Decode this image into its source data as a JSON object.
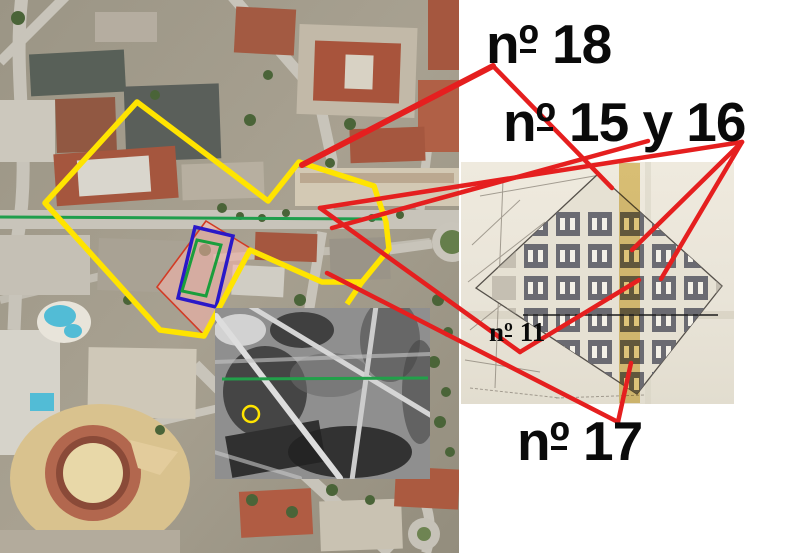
{
  "figure": {
    "type": "annotated-composite-map-figure",
    "description": "Modern aerial photo with outlined shelter zones, historical plan scan and WWII-era aerial inset, linked by red call-out lines"
  },
  "labels": [
    {
      "id": "no18",
      "font": "sans",
      "x": 486,
      "y": 17,
      "size": 55,
      "parts": {
        "prefix": "n",
        "ordinal": "º",
        "rest": " 18"
      }
    },
    {
      "id": "no15y16",
      "font": "sans",
      "x": 503,
      "y": 95,
      "size": 55,
      "parts": {
        "prefix": "n",
        "ordinal": "º",
        "rest": " 15 y 16"
      }
    },
    {
      "id": "no11",
      "font": "serif",
      "x": 489,
      "y": 319,
      "size": 27,
      "parts": {
        "prefix": "n",
        "ordinal": "º",
        "rest": " 11"
      }
    },
    {
      "id": "no17",
      "font": "sans",
      "x": 517,
      "y": 414,
      "size": 55,
      "parts": {
        "prefix": "n",
        "ordinal": "º",
        "rest": " 17"
      }
    }
  ],
  "colors": {
    "callout_red": "#e51f1f",
    "zone_yellow": "#ffe400",
    "section_green": "#1f9e4c",
    "inset_green": "#22a04a",
    "rect_blue": "#2a18c8",
    "rect_green": "#1a9e3c",
    "area_pink_fill": "rgba(249,180,172,0.55)",
    "area_pink_stroke": "#d23b25",
    "plan_gold_stripe": "#d8b23a",
    "plan_paper": "#ece7dc",
    "plan_block_gray": "#6b6b72"
  },
  "overlay": {
    "red_lines": [
      [
        493,
        66,
        302,
        165,
        6.0
      ],
      [
        493,
        66,
        612,
        188,
        4.5
      ],
      [
        648,
        141,
        332,
        228,
        4.5
      ],
      [
        742,
        142,
        320,
        208,
        4.5
      ],
      [
        742,
        142,
        661,
        279,
        4.5
      ],
      [
        742,
        142,
        632,
        250,
        4.5
      ],
      [
        327,
        273,
        618,
        422,
        4.5
      ],
      [
        618,
        422,
        631,
        363,
        4.5
      ],
      [
        320,
        208,
        520,
        352,
        4.5
      ],
      [
        520,
        352,
        639,
        280,
        4.5
      ]
    ],
    "yellow_polygon": "137,102 230,172 268,201 299,162 374,186 386,222 389,249 362,282 322,282 250,250 204,336 160,330 45,203",
    "yellow_stub": [
      362,
      282,
      347,
      304
    ],
    "green_section_line": [
      0,
      217,
      384,
      219
    ],
    "inset_green_line": [
      222,
      379,
      428,
      378
    ],
    "inset_yellow_circle": {
      "cx": 251,
      "cy": 414,
      "r": 8
    },
    "pink_polygon": "206,221 250,248 204,335 157,287",
    "blue_polygon": "195,227 233,236 216,307 178,298",
    "green_polygon": "197,240 221,245 206,296 182,291"
  }
}
